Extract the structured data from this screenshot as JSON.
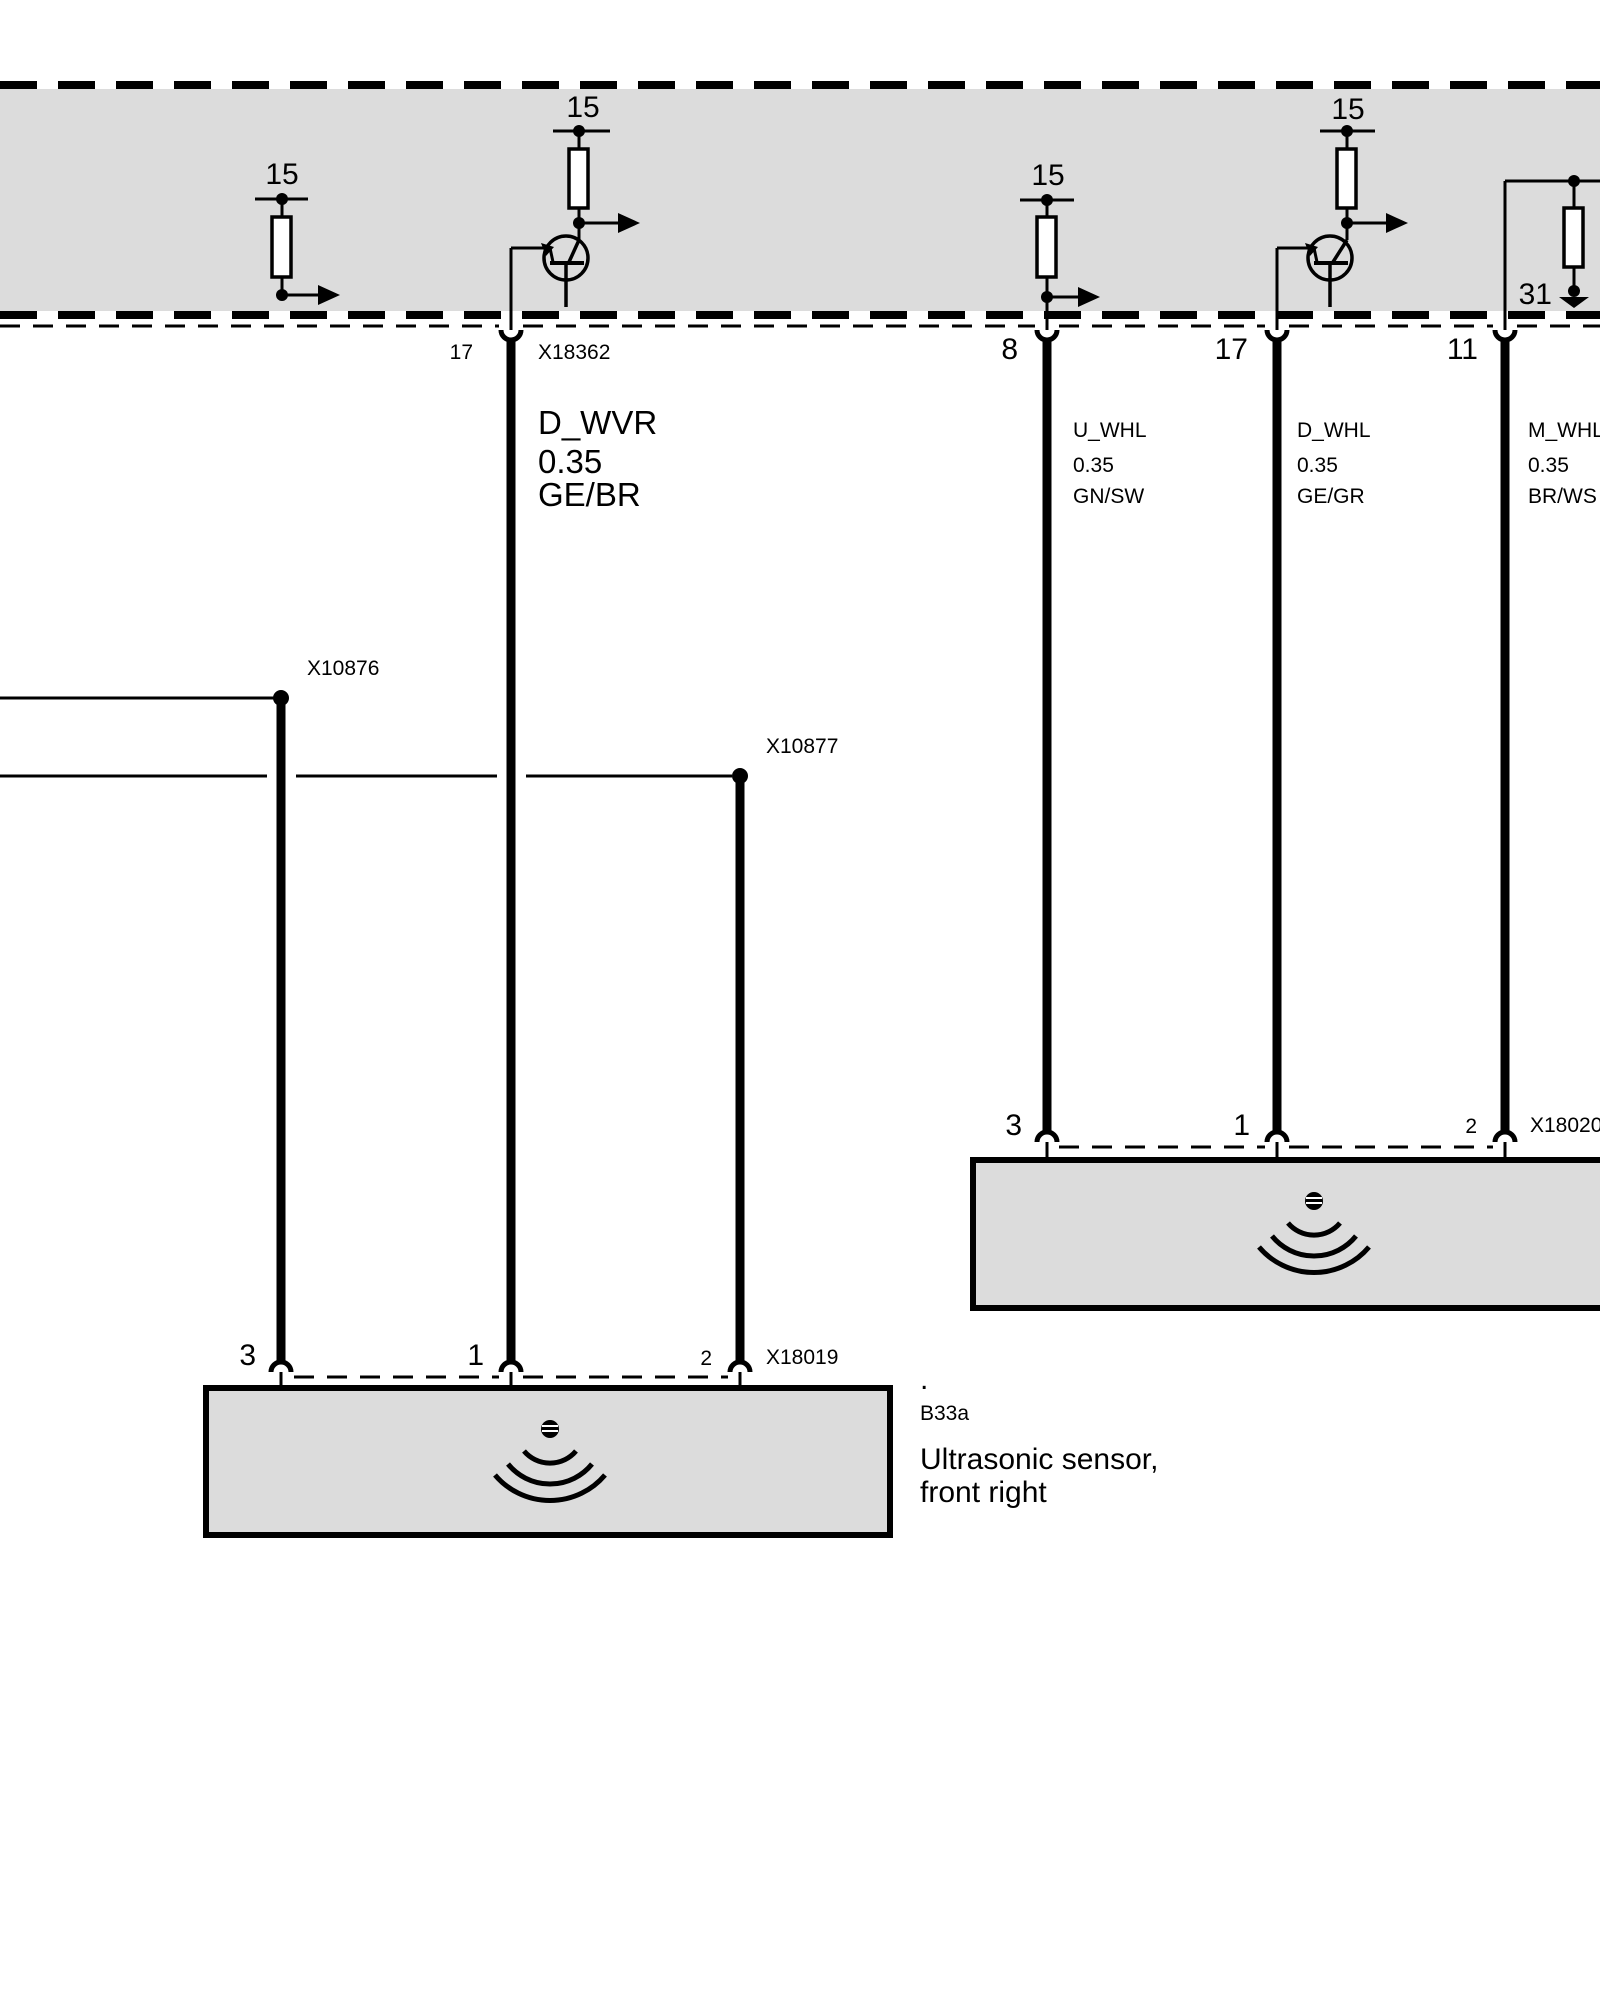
{
  "colors": {
    "module_fill": "#dcdcdc",
    "box_fill": "#dcdcdc",
    "line": "#000000"
  },
  "module": {
    "terminal_15": "15",
    "terminal_31": "31"
  },
  "top_row": {
    "left_connector": {
      "pin": "17",
      "id": "X18362"
    },
    "right_pins": [
      {
        "pin": "8"
      },
      {
        "pin": "17"
      },
      {
        "pin": "11"
      }
    ]
  },
  "wire_labels": [
    {
      "signal": "D_WVR",
      "cross_section": "0.35",
      "color_code": "GE/BR"
    },
    {
      "signal": "U_WHL",
      "cross_section": "0.35",
      "color_code": "GN/SW"
    },
    {
      "signal": "D_WHL",
      "cross_section": "0.35",
      "color_code": "GE/GR"
    },
    {
      "signal": "M_WHL",
      "cross_section": "0.35",
      "color_code": "BR/WS"
    }
  ],
  "splice_connectors": [
    {
      "id": "X10876"
    },
    {
      "id": "X10877"
    }
  ],
  "sensor_left": {
    "pins": [
      {
        "pin": "3"
      },
      {
        "pin": "1"
      },
      {
        "pin": "2"
      }
    ],
    "connector_id": "X18019",
    "dot": ".",
    "component_ref": "B33a",
    "component_name_line1": "Ultrasonic sensor,",
    "component_name_line2": "front right"
  },
  "sensor_right": {
    "pins": [
      {
        "pin": "3"
      },
      {
        "pin": "1"
      },
      {
        "pin": "2"
      }
    ],
    "connector_id": "X18020"
  }
}
